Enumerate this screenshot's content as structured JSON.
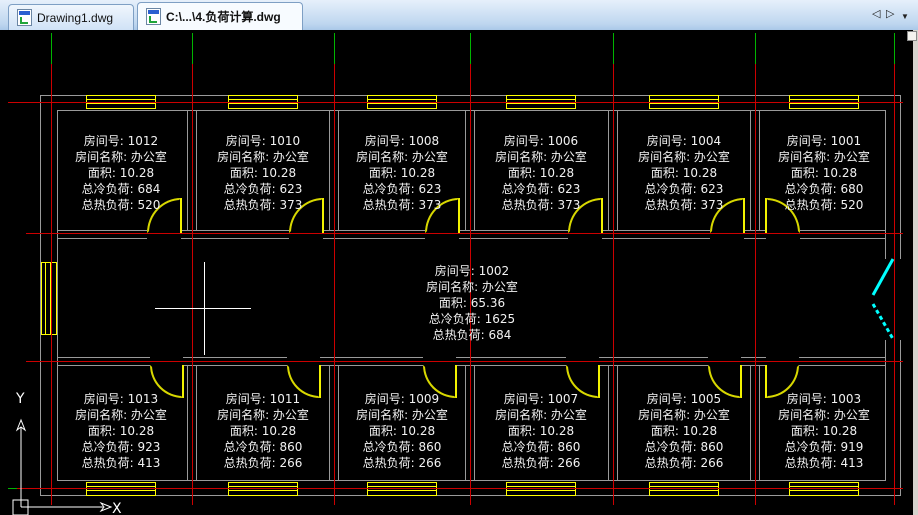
{
  "tabs": [
    {
      "label": "Drawing1.dwg",
      "active": false
    },
    {
      "label": "C:\\...\\4.负荷计算.dwg",
      "active": true
    }
  ],
  "tabnav": {
    "prev": "◁",
    "next": "▷",
    "menu": "▼"
  },
  "ucs": {
    "x_label": "X",
    "y_label": "Y"
  },
  "colors": {
    "axis_line": "#cc0000",
    "axis_end": "#00b400",
    "wall": "#9a9a9a",
    "fixture": "#ffff00",
    "entrance_door": "#00ffff",
    "label_text": "#ffffff",
    "tabbar_bg": "#bed6ef"
  },
  "rooms": [
    {
      "id": "1012",
      "lines": [
        "房间号: 1012",
        "房间名称: 办公室",
        "面积: 10.28",
        "总冷负荷: 684",
        "总热负荷: 520"
      ]
    },
    {
      "id": "1010",
      "lines": [
        "房间号: 1010",
        "房间名称: 办公室",
        "面积: 10.28",
        "总冷负荷: 623",
        "总热负荷: 373"
      ]
    },
    {
      "id": "1008",
      "lines": [
        "房间号: 1008",
        "房间名称: 办公室",
        "面积: 10.28",
        "总冷负荷: 623",
        "总热负荷: 373"
      ]
    },
    {
      "id": "1006",
      "lines": [
        "房间号: 1006",
        "房间名称: 办公室",
        "面积: 10.28",
        "总冷负荷: 623",
        "总热负荷: 373"
      ]
    },
    {
      "id": "1004",
      "lines": [
        "房间号: 1004",
        "房间名称: 办公室",
        "面积: 10.28",
        "总冷负荷: 623",
        "总热负荷: 373"
      ]
    },
    {
      "id": "1001",
      "lines": [
        "房间号: 1001",
        "房间名称: 办公室",
        "面积: 10.28",
        "总冷负荷: 680",
        "总热负荷: 520"
      ]
    },
    {
      "id": "1002",
      "lines": [
        "房间号: 1002",
        "房间名称: 办公室",
        "面积: 65.36",
        "总冷负荷: 1625",
        "总热负荷: 684"
      ]
    },
    {
      "id": "1013",
      "lines": [
        "房间号: 1013",
        "房间名称: 办公室",
        "面积: 10.28",
        "总冷负荷: 923",
        "总热负荷: 413"
      ]
    },
    {
      "id": "1011",
      "lines": [
        "房间号: 1011",
        "房间名称: 办公室",
        "面积: 10.28",
        "总冷负荷: 860",
        "总热负荷: 266"
      ]
    },
    {
      "id": "1009",
      "lines": [
        "房间号: 1009",
        "房间名称: 办公室",
        "面积: 10.28",
        "总冷负荷: 860",
        "总热负荷: 266"
      ]
    },
    {
      "id": "1007",
      "lines": [
        "房间号: 1007",
        "房间名称: 办公室",
        "面积: 10.28",
        "总冷负荷: 860",
        "总热负荷: 266"
      ]
    },
    {
      "id": "1005",
      "lines": [
        "房间号: 1005",
        "房间名称: 办公室",
        "面积: 10.28",
        "总冷负荷: 860",
        "总热负荷: 266"
      ]
    },
    {
      "id": "1003",
      "lines": [
        "房间号: 1003",
        "房间名称: 办公室",
        "面积: 10.28",
        "总冷负荷: 919",
        "总热负荷: 413"
      ]
    }
  ]
}
